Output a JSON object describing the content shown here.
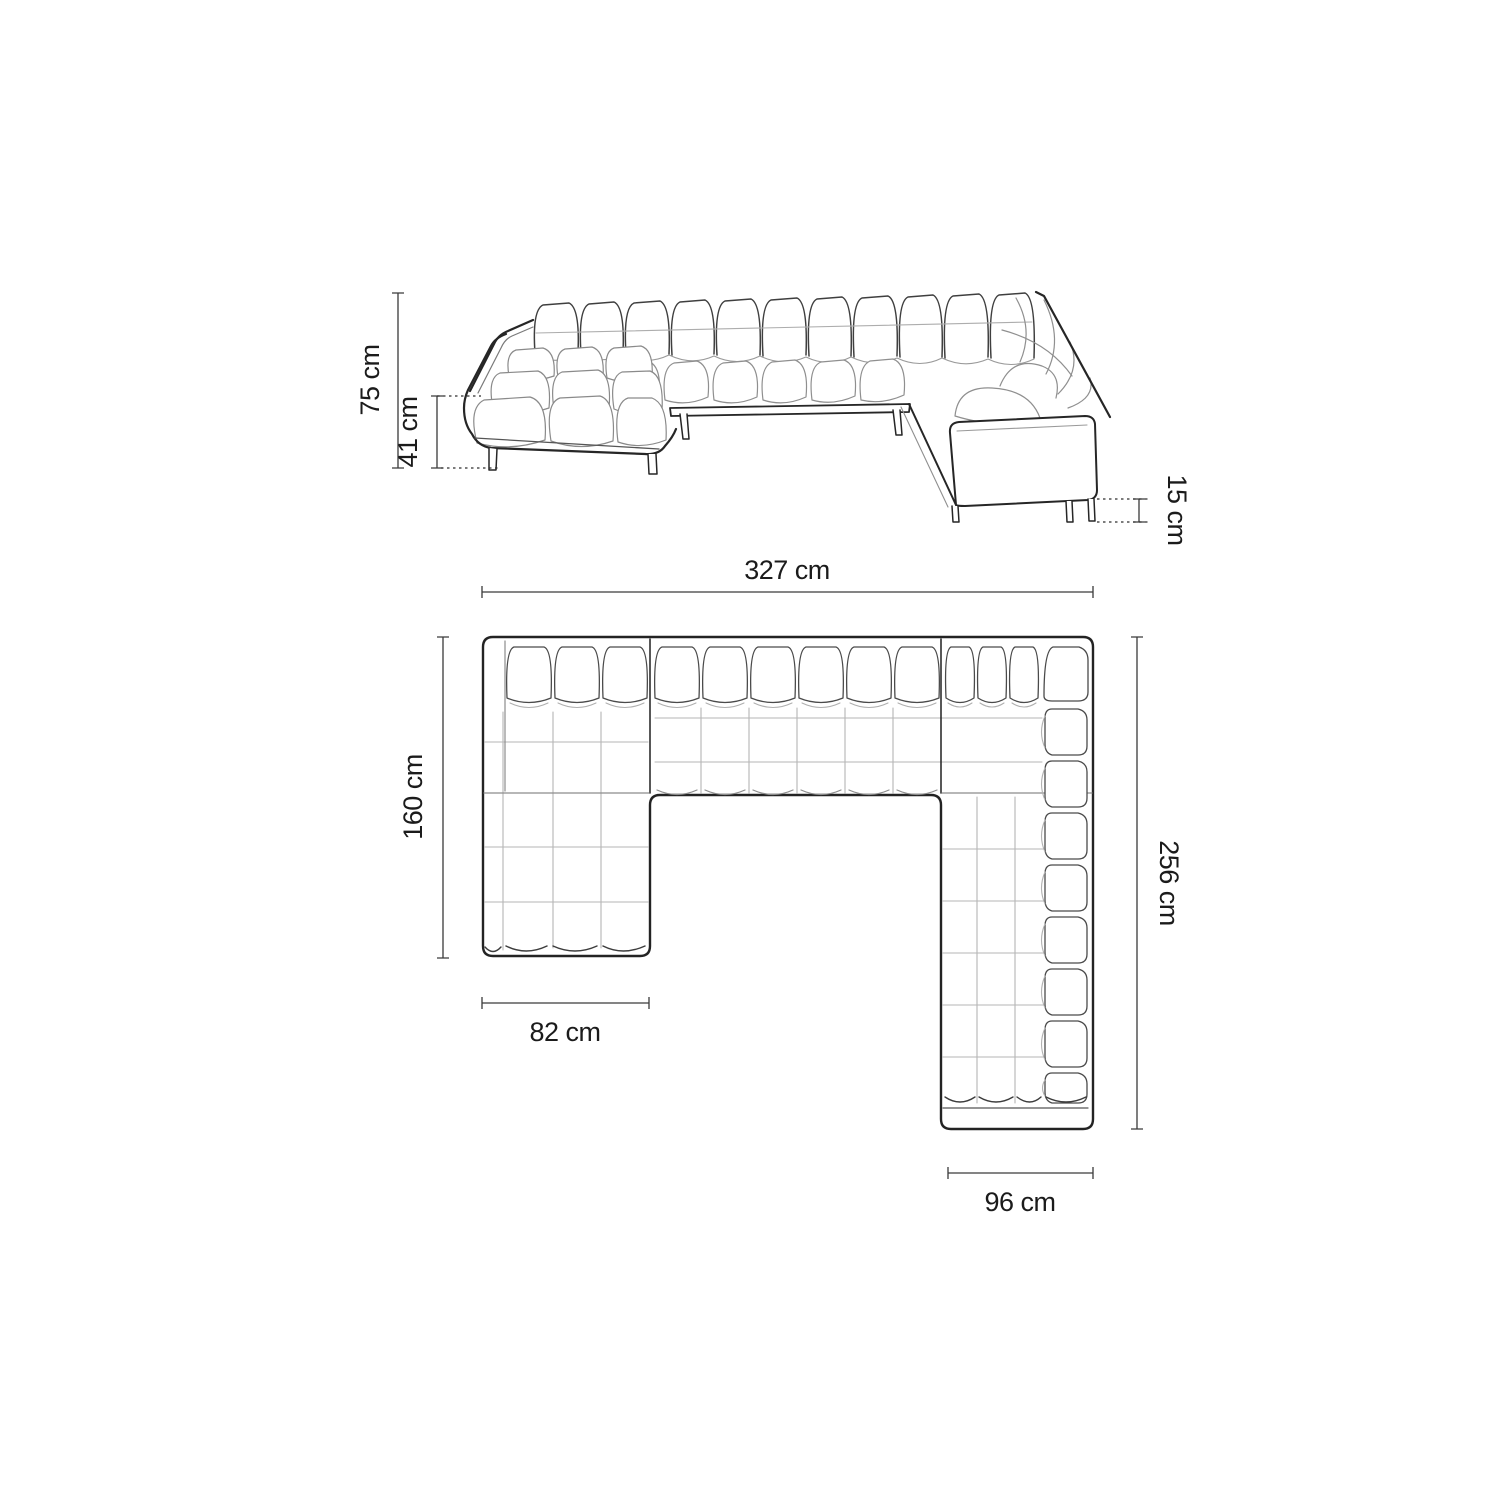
{
  "diagram": {
    "subject": "u-shaped-corner-sofa-dimension-diagram",
    "views": [
      "perspective-front-view",
      "top-plan-view"
    ],
    "unit": "cm",
    "dimensions": {
      "total_height": {
        "value": 75,
        "unit": "cm",
        "label": "75 cm"
      },
      "seat_height": {
        "value": 41,
        "unit": "cm",
        "label": "41 cm"
      },
      "leg_height": {
        "value": 15,
        "unit": "cm",
        "label": "15 cm"
      },
      "total_width": {
        "value": 327,
        "unit": "cm",
        "label": "327 cm"
      },
      "left_chaise_depth": {
        "value": 160,
        "unit": "cm",
        "label": "160 cm"
      },
      "left_chaise_width": {
        "value": 82,
        "unit": "cm",
        "label": "82 cm"
      },
      "right_side_depth": {
        "value": 256,
        "unit": "cm",
        "label": "256 cm"
      },
      "right_side_width": {
        "value": 96,
        "unit": "cm",
        "label": "96 cm"
      }
    },
    "colors": {
      "background": "#ffffff",
      "outline": "#262626",
      "cushion_line": "#4a4a4a",
      "tuft_line": "#b5b5b5",
      "dimension_line": "#3a3a3a",
      "text": "#1b1b1b"
    }
  }
}
